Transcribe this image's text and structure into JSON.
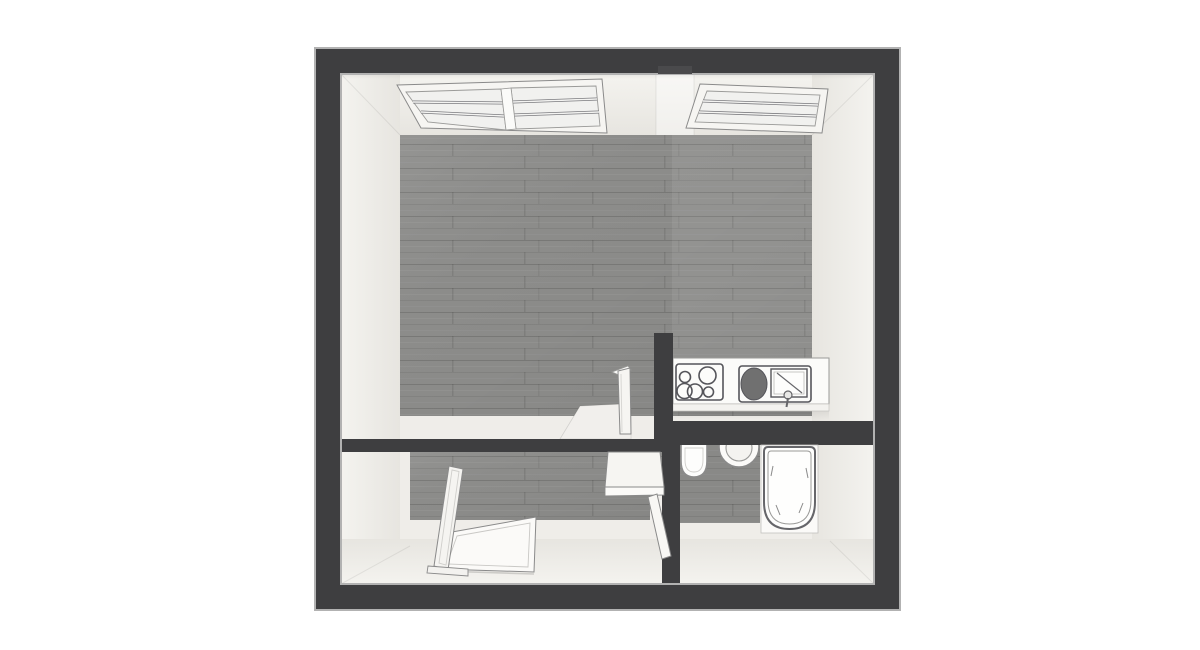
{
  "scene": {
    "type": "3d-floorplan-top-view",
    "objects": [
      "outer-walls",
      "skylight-double",
      "skylight-single",
      "main-room-wood-floor",
      "partition-wall",
      "interior-door-leaf",
      "kitchen-counter",
      "cooktop-4-burners",
      "kitchen-sink-unit",
      "hallway-wood-floor",
      "hallway-standing-panel",
      "hallway-floor-panel",
      "hallway-table",
      "bathroom-door-leaf",
      "toilet",
      "washbasin-round",
      "bathtub"
    ]
  },
  "colors": {
    "background": "#ffffff",
    "wall-dark": "#3e3e40",
    "wall-outline": "#b2b2b2",
    "wall-face": "#efede9",
    "wall-face-bright": "#f4f3ef",
    "wall-face-shade": "#e7e5e0",
    "floor-wood": "#8e8e8c",
    "fixture-fill": "#fcfcfa",
    "fixture-outline": "#6f6f72",
    "sink-basin": "#707070",
    "swing-area": "#f1efec"
  }
}
